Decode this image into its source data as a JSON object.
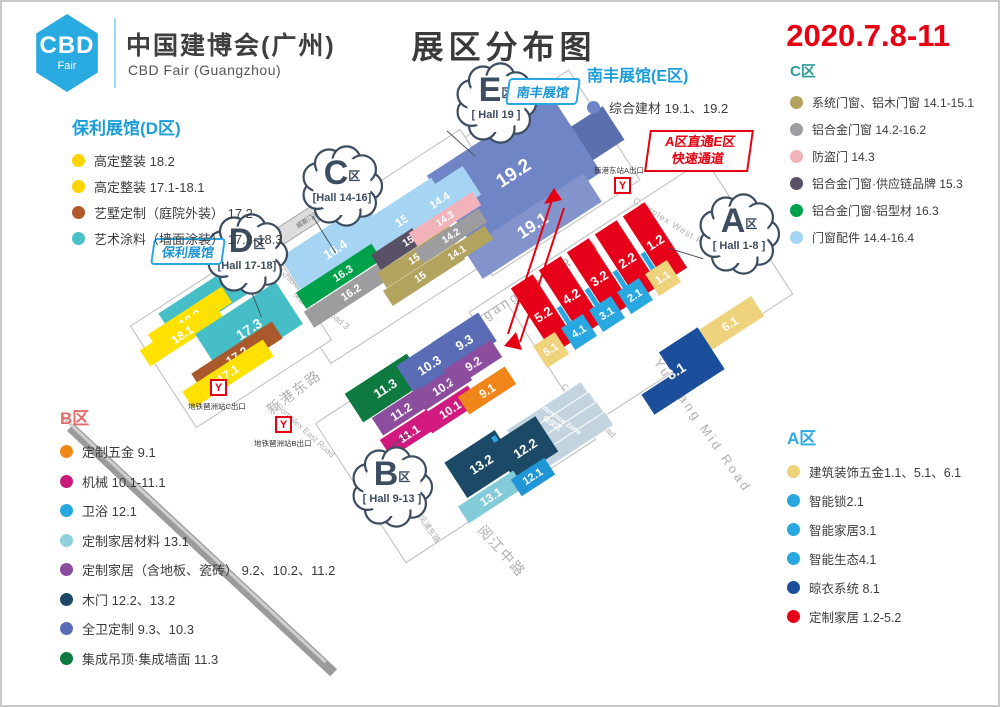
{
  "header": {
    "logo_line1": "CBD",
    "logo_line2": "Fair",
    "brand": "中国建博会(广州)",
    "brand_en": "CBD Fair (Guangzhou)",
    "title": "展区分布图",
    "date": "2020.7.8-11",
    "accent_blue": "#29abe2",
    "accent_red": "#e60012"
  },
  "legend_d": {
    "title": "保利展馆(D区)",
    "color": "#1b9dd8",
    "items": [
      {
        "t": "高定整装 18.2",
        "c": "#fcd303"
      },
      {
        "t": "高定整装 17.1-18.1",
        "c": "#fcd303"
      },
      {
        "t": "艺墅定制（庭院外装） 17.2",
        "c": "#b2592a"
      },
      {
        "t": "艺术涂料（墙面涂装） 17.3-18.3",
        "c": "#4bc0c8"
      }
    ]
  },
  "legend_b": {
    "title": "B区",
    "color": "#e06d6a",
    "items": [
      {
        "t": "定制五金 9.1",
        "c": "#f08519"
      },
      {
        "t": "机械 10.1-11.1",
        "c": "#ca1a7d"
      },
      {
        "t": "卫浴 12.1",
        "c": "#29a7e0"
      },
      {
        "t": "定制家居材料 13.1",
        "c": "#8fd0da"
      },
      {
        "t": "定制家居（含地板、瓷砖） 9.2、10.2、11.2",
        "c": "#8d4d9f"
      },
      {
        "t": "木门 12.2、13.2",
        "c": "#1c4a66"
      },
      {
        "t": "全卫定制 9.3、10.3",
        "c": "#5a6cb5"
      },
      {
        "t": "集成吊顶·集成墙面 11.3",
        "c": "#0e7a40"
      }
    ]
  },
  "legend_c": {
    "title": "C区",
    "color": "#2b9e9c",
    "items": [
      {
        "t": "系统门窗、铝木门窗 14.1-15.1",
        "c": "#b2a35e"
      },
      {
        "t": "铝合金门窗 14.2-16.2",
        "c": "#9d9da0"
      },
      {
        "t": "防盗门 14.3",
        "c": "#f2b2ba"
      },
      {
        "t": "铝合金门窗·供应链品牌 15.3",
        "c": "#585166"
      },
      {
        "t": "铝合金门窗·铝型材 16.3",
        "c": "#00a14b"
      },
      {
        "t": "门窗配件 14.4-16.4",
        "c": "#a5d5f2"
      }
    ]
  },
  "legend_a": {
    "title": "A区",
    "color": "#29abe2",
    "items": [
      {
        "t": "建筑装饰五金1.1、5.1、6.1",
        "c": "#eed27c"
      },
      {
        "t": "智能锁2.1",
        "c": "#29a7e0"
      },
      {
        "t": "智能家居3.1",
        "c": "#29a7e0"
      },
      {
        "t": "智能生态4.1",
        "c": "#29a7e0"
      },
      {
        "t": "晾衣系统 8.1",
        "c": "#1b4e9b"
      },
      {
        "t": "定制家居 1.2-5.2",
        "c": "#e60019"
      }
    ]
  },
  "legend_e": {
    "title": "南丰展馆(E区)",
    "color": "#1b9dd8",
    "items": [
      {
        "t": "综合建材 19.1、19.2",
        "c": "#7085c5"
      }
    ]
  },
  "map": {
    "badges": [
      {
        "id": "E",
        "letter": "E",
        "qu": "区",
        "hall": "[ Hall 19 ]",
        "x": 450,
        "y": 57
      },
      {
        "id": "C",
        "letter": "C",
        "qu": "区",
        "hall": "[Hall 14-16]",
        "x": 296,
        "y": 140
      },
      {
        "id": "D",
        "letter": "D",
        "qu": "区",
        "hall": "[Hall 17-18]",
        "x": 201,
        "y": 208
      },
      {
        "id": "A",
        "letter": "A",
        "qu": "区",
        "hall": "[ Hall 1-8 ]",
        "x": 693,
        "y": 188
      },
      {
        "id": "B",
        "letter": "B",
        "qu": "区",
        "hall": "[ Hall 9-13 ]",
        "x": 346,
        "y": 441
      }
    ],
    "tags": [
      {
        "t": "南丰展馆",
        "x": 505,
        "y": 76
      },
      {
        "t": "保利展馆",
        "x": 150,
        "y": 236
      }
    ],
    "corridor": {
      "line1": "A区直通E区",
      "line2": "快速通道",
      "x": 645,
      "y": 128,
      "w": 94
    },
    "hotel": {
      "t": "威斯汀酒店",
      "x": 307,
      "y": 214,
      "w": 84,
      "h": 16
    },
    "compass_label": "N",
    "conference": {
      "line1": "Conference Zone",
      "line2": "会议区"
    },
    "metros": [
      {
        "label": "地铁琶洲站C出口",
        "ix": 208,
        "iy": 377,
        "lx": 186,
        "ly": 399
      },
      {
        "label": "地铁琶洲站B出口",
        "ix": 273,
        "iy": 414,
        "lx": 252,
        "ly": 436
      },
      {
        "label": "新港东站A出口",
        "ix": 612,
        "iy": 175,
        "lx": 592,
        "ly": 163
      }
    ],
    "roads": [
      {
        "t": "Exhibition South Road 1",
        "t2": "保盈南一街",
        "x": 560,
        "y": 125,
        "r": 32,
        "fs": 8.5
      },
      {
        "t": "Exhibition South Road 2",
        "t2": "保盈南二街",
        "x": 494,
        "y": 213,
        "r": 32,
        "fs": 8
      },
      {
        "t": "Exhibition South Road 3",
        "t2": "保盈南三街",
        "x": 308,
        "y": 300,
        "r": 40,
        "fs": 8.5
      },
      {
        "t": "Xingang East Road",
        "x": 528,
        "y": 286,
        "r": -33,
        "fs": 13,
        "sp": 3
      },
      {
        "t": "新港东路",
        "x": 292,
        "y": 390,
        "r": -37,
        "fs": 14,
        "sp": 2
      },
      {
        "t": "Complex West Road",
        "x": 674,
        "y": 224,
        "r": 32,
        "fs": 9,
        "sp": 1
      },
      {
        "t": "Complex Mid Road",
        "x": 586,
        "y": 409,
        "r": 45,
        "fs": 8.5
      },
      {
        "t": "Complex East Road",
        "x": 303,
        "y": 429,
        "r": 42,
        "fs": 8.5
      },
      {
        "t": "Yuejiang Mid Road",
        "x": 700,
        "y": 424,
        "r": 55,
        "fs": 13,
        "sp": 3
      },
      {
        "t": "阅江中路",
        "x": 500,
        "y": 549,
        "r": 48,
        "fs": 14,
        "sp": 2
      },
      {
        "t": "凤浦东路",
        "x": 427,
        "y": 527,
        "r": 55,
        "fs": 8
      }
    ],
    "blocks": [
      {
        "n": "",
        "c": "#5b6fae",
        "x": 573,
        "y": 146,
        "w": 92,
        "h": 40
      },
      {
        "n": "19.2",
        "c": "#7085c5",
        "x": 512,
        "y": 172,
        "w": 148,
        "h": 92,
        "fs": 19
      },
      {
        "n": "19.1",
        "c": "#8394cd",
        "x": 531,
        "y": 224,
        "w": 142,
        "h": 34,
        "fs": 17
      },
      {
        "n": "16.4",
        "c": "#a5d5f2",
        "x": 333,
        "y": 247,
        "w": 102,
        "h": 46,
        "fs": 13
      },
      {
        "n": "16.3",
        "c": "#00a14b",
        "x": 341,
        "y": 271,
        "w": 100,
        "h": 19,
        "fs": 11
      },
      {
        "n": "16.2",
        "c": "#9d9da0",
        "x": 349,
        "y": 290,
        "w": 100,
        "h": 19,
        "fs": 11
      },
      {
        "n": "15.4",
        "c": "#a5d5f2",
        "x": 404,
        "y": 216,
        "w": 86,
        "h": 40,
        "fs": 12
      },
      {
        "n": "15.3",
        "c": "#585166",
        "x": 410,
        "y": 237,
        "w": 86,
        "h": 18,
        "fs": 10.5
      },
      {
        "n": "15.2",
        "c": "#b2a35e",
        "x": 416,
        "y": 255,
        "w": 86,
        "h": 18,
        "fs": 10.5
      },
      {
        "n": "15.1",
        "c": "#b2a35e",
        "x": 422,
        "y": 273,
        "w": 86,
        "h": 18,
        "fs": 10.5
      },
      {
        "n": "14.4",
        "c": "#a5d5f2",
        "x": 438,
        "y": 199,
        "w": 76,
        "h": 34,
        "fs": 11
      },
      {
        "n": "14.3",
        "c": "#f2b2ba",
        "x": 443,
        "y": 217,
        "w": 76,
        "h": 16,
        "fs": 10
      },
      {
        "n": "14.2",
        "c": "#9d9da0",
        "x": 449,
        "y": 234,
        "w": 76,
        "h": 16,
        "fs": 10
      },
      {
        "n": "14.1",
        "c": "#b2a35e",
        "x": 455,
        "y": 251,
        "w": 76,
        "h": 16,
        "fs": 10
      },
      {
        "n": "18.3",
        "c": "#45bec8",
        "x": 202,
        "y": 301,
        "w": 88,
        "h": 32,
        "fs": 13
      },
      {
        "n": "18.2",
        "c": "#ffe100",
        "x": 188,
        "y": 316,
        "w": 88,
        "h": 19,
        "fs": 12
      },
      {
        "n": "18.1",
        "c": "#ffe100",
        "x": 180,
        "y": 332,
        "w": 88,
        "h": 19,
        "fs": 12
      },
      {
        "n": "17.3",
        "c": "#45bec8",
        "x": 247,
        "y": 327,
        "w": 96,
        "h": 50,
        "fs": 14
      },
      {
        "n": "17.2",
        "c": "#a9592c",
        "x": 235,
        "y": 354,
        "w": 96,
        "h": 20,
        "fs": 12
      },
      {
        "n": "17.1",
        "c": "#ffe100",
        "x": 226,
        "y": 372,
        "w": 96,
        "h": 20,
        "fs": 12
      },
      {
        "n": "5.2",
        "c": "#e60019",
        "x": 541,
        "y": 312,
        "w": 26,
        "h": 78,
        "fs": 13
      },
      {
        "n": "4.2",
        "c": "#e60019",
        "x": 569,
        "y": 294,
        "w": 26,
        "h": 78,
        "fs": 13
      },
      {
        "n": "3.2",
        "c": "#e60019",
        "x": 597,
        "y": 276,
        "w": 26,
        "h": 78,
        "fs": 13
      },
      {
        "n": "2.2",
        "c": "#e60019",
        "x": 625,
        "y": 258,
        "w": 26,
        "h": 78,
        "fs": 13
      },
      {
        "n": "1.2",
        "c": "#e60019",
        "x": 653,
        "y": 240,
        "w": 26,
        "h": 78,
        "fs": 13
      },
      {
        "n": "",
        "c": "#29a7e0",
        "x": 566,
        "y": 320,
        "w": 5,
        "h": 36
      },
      {
        "n": "",
        "c": "#29a7e0",
        "x": 594,
        "y": 302,
        "w": 5,
        "h": 36
      },
      {
        "n": "",
        "c": "#29a7e0",
        "x": 622,
        "y": 284,
        "w": 5,
        "h": 36
      },
      {
        "n": "",
        "c": "#29a7e0",
        "x": 650,
        "y": 266,
        "w": 5,
        "h": 36
      },
      {
        "n": "5.1",
        "c": "#eed27c",
        "x": 549,
        "y": 348,
        "w": 26,
        "h": 26,
        "fs": 11
      },
      {
        "n": "4.1",
        "c": "#29a7e0",
        "x": 577,
        "y": 330,
        "w": 26,
        "h": 26,
        "fs": 11
      },
      {
        "n": "3.1",
        "c": "#29a7e0",
        "x": 605,
        "y": 312,
        "w": 26,
        "h": 26,
        "fs": 11
      },
      {
        "n": "2.1",
        "c": "#29a7e0",
        "x": 633,
        "y": 294,
        "w": 26,
        "h": 26,
        "fs": 11
      },
      {
        "n": "1.1",
        "c": "#eed27c",
        "x": 661,
        "y": 276,
        "w": 26,
        "h": 26,
        "fs": 11
      },
      {
        "n": "6.1",
        "c": "#eed27c",
        "x": 728,
        "y": 322,
        "w": 66,
        "h": 24,
        "fs": 12
      },
      {
        "n": "8.1",
        "c": "#1b4e9b",
        "x": 674,
        "y": 369,
        "w": 84,
        "h": 50,
        "fs": 14,
        "clip": "L"
      },
      {
        "n": "11.3",
        "c": "#0e7a40",
        "x": 383,
        "y": 386,
        "w": 74,
        "h": 34,
        "fs": 13
      },
      {
        "n": "10.3",
        "c": "#5a6cb5",
        "x": 427,
        "y": 363,
        "w": 56,
        "h": 34,
        "fs": 13
      },
      {
        "n": "9.3",
        "c": "#5a6cb5",
        "x": 462,
        "y": 340,
        "w": 56,
        "h": 34,
        "fs": 13
      },
      {
        "n": "11.2",
        "c": "#8d4d9f",
        "x": 399,
        "y": 409,
        "w": 56,
        "h": 21,
        "fs": 12
      },
      {
        "n": "10.2",
        "c": "#8d4d9f",
        "x": 441,
        "y": 384,
        "w": 56,
        "h": 21,
        "fs": 12
      },
      {
        "n": "9.2",
        "c": "#8d4d9f",
        "x": 471,
        "y": 361,
        "w": 56,
        "h": 21,
        "fs": 12
      },
      {
        "n": "11.1",
        "c": "#d2197f",
        "x": 407,
        "y": 431,
        "w": 56,
        "h": 21,
        "fs": 12
      },
      {
        "n": "10.1",
        "c": "#d2197f",
        "x": 448,
        "y": 407,
        "w": 56,
        "h": 21,
        "fs": 12
      },
      {
        "n": "9.1",
        "c": "#f08519",
        "x": 485,
        "y": 388,
        "w": 56,
        "h": 21,
        "fs": 12
      },
      {
        "n": "13.2",
        "c": "#1c4a66",
        "x": 479,
        "y": 462,
        "w": 60,
        "h": 42,
        "fs": 13
      },
      {
        "n": "",
        "c": "#2aa7e0",
        "x": 502,
        "y": 452,
        "w": 5,
        "h": 42
      },
      {
        "n": "12.2",
        "c": "#1c4a66",
        "x": 523,
        "y": 446,
        "w": 52,
        "h": 42,
        "fs": 13
      },
      {
        "n": "13.1",
        "c": "#84cbd9",
        "x": 489,
        "y": 495,
        "w": 66,
        "h": 20,
        "fs": 12
      },
      {
        "n": "12.1",
        "c": "#2196d6",
        "x": 531,
        "y": 475,
        "w": 40,
        "h": 20,
        "fs": 11
      }
    ]
  }
}
